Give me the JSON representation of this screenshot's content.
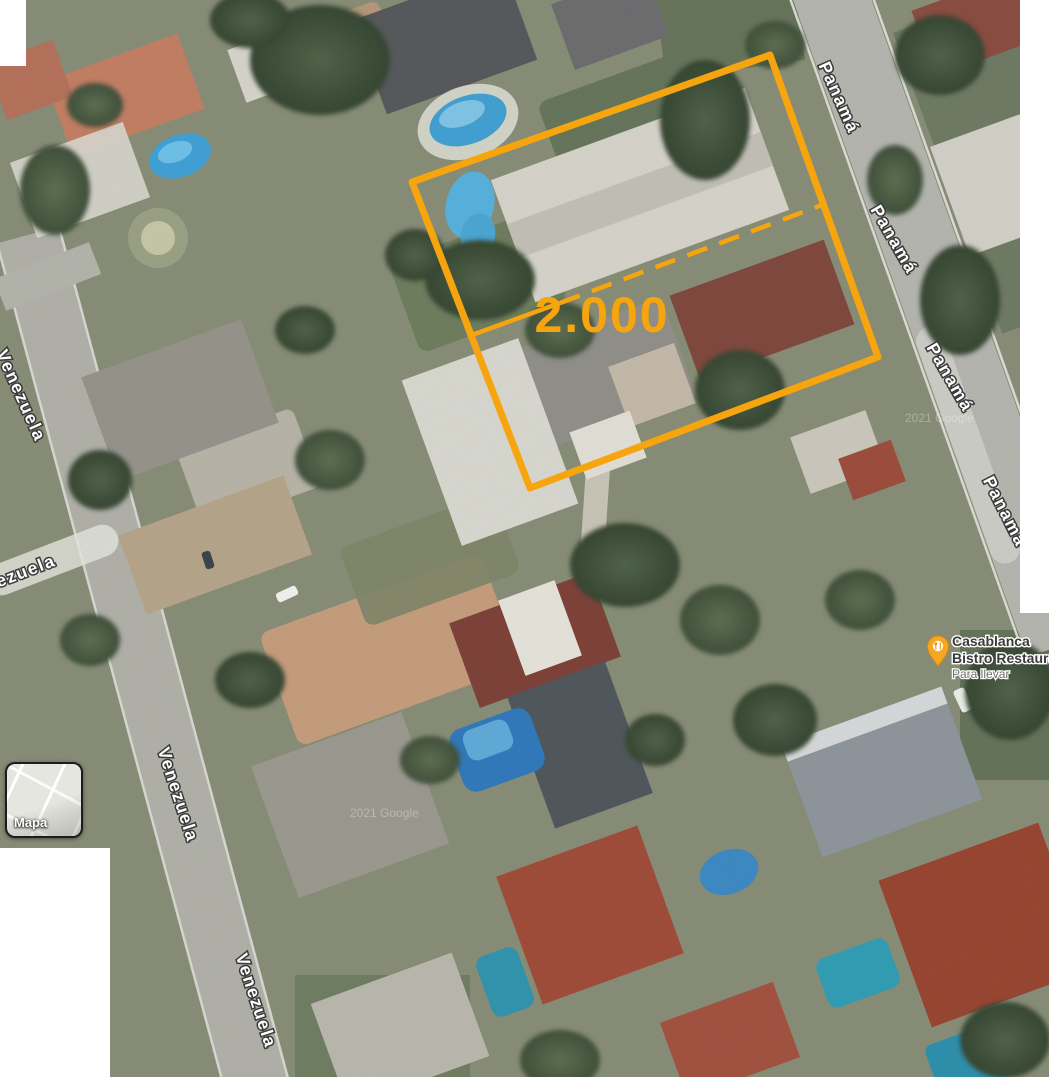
{
  "plot": {
    "area_label": "2.000",
    "outline_color": "#F7A50F"
  },
  "streets": {
    "panama_labels": [
      "Panamá",
      "Panamá",
      "Panamá",
      "Panamá"
    ],
    "venezuela_labels": [
      "Venezuela",
      "ezuela",
      "Venezuela",
      "Venezuela"
    ]
  },
  "poi": {
    "name": "Casablanca",
    "category_line": "Bistro Restaura",
    "service_note": "Para llevar",
    "marker_color": "#F5A623"
  },
  "controls": {
    "map_type_label": "Mapa"
  },
  "attribution": {
    "text": "2021 Google"
  }
}
